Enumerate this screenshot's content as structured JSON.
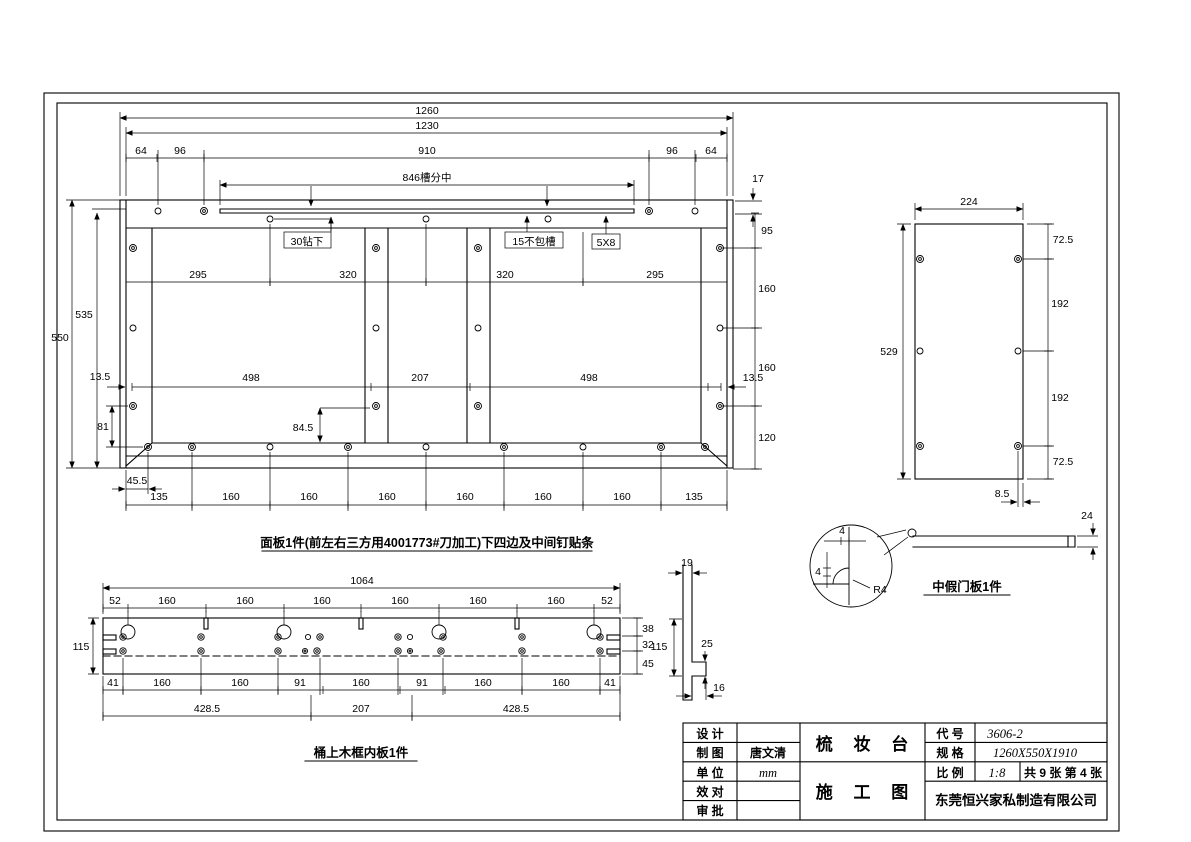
{
  "sheet": {
    "product": "梳 妆 台",
    "doc_type": "施 工 图",
    "fields": [
      {
        "label": "设 计",
        "value": ""
      },
      {
        "label": "制 图",
        "value": "唐文清"
      },
      {
        "label": "单 位",
        "value": "mm"
      },
      {
        "label": "效 对",
        "value": ""
      },
      {
        "label": "审 批",
        "value": ""
      }
    ],
    "code_label": "代 号",
    "code": "3606-2",
    "spec_label": "规 格",
    "spec": "1260X550X1910",
    "scale_label": "比 例",
    "scale": "1:8",
    "sheet_count": "共 9 张 第 4 张",
    "company": "东莞恒兴家私制造有限公司"
  },
  "panel": {
    "caption": "面板1件(前左右三方用4001773#刀加工)下四边及中间钉贴条",
    "d1260": "1260",
    "d1230": "1230",
    "chain_top": [
      "64",
      "96",
      "910",
      "96",
      "64"
    ],
    "d846": "846槽分中",
    "d17": "17",
    "note30": "30钻下",
    "note15": "15不包槽",
    "note5x8": "5X8",
    "chain_mid": [
      "295",
      "320",
      "320",
      "295"
    ],
    "d535": "535",
    "d550": "550",
    "d135l": "13.5",
    "d135r": "13.5",
    "chain_low": [
      "498",
      "207",
      "498"
    ],
    "d81": "81",
    "d845": "84.5",
    "d455": "45.5",
    "chain_right": [
      "95",
      "160",
      "160",
      "120"
    ],
    "chain_bottom": [
      "135",
      "160",
      "160",
      "160",
      "160",
      "160",
      "160",
      "135"
    ]
  },
  "door": {
    "caption": "中假门板1件",
    "d224": "224",
    "d529": "529",
    "chain_right": [
      "72.5",
      "192",
      "192",
      "72.5"
    ],
    "d85": "8.5",
    "d24": "24",
    "d4a": "4",
    "d4b": "4",
    "dr4": "R4"
  },
  "strip": {
    "caption": "桶上木框内板1件",
    "d1064": "1064",
    "chain_top": [
      "52",
      "160",
      "160",
      "160",
      "160",
      "160",
      "160",
      "52"
    ],
    "d115": "115",
    "chain_right": [
      "38",
      "32",
      "45"
    ],
    "chain_bot": [
      "41",
      "160",
      "160",
      "91",
      "160",
      "91",
      "160",
      "160",
      "41"
    ],
    "chain_bot2": [
      "428.5",
      "207",
      "428.5"
    ],
    "p19": "19",
    "p115": "115",
    "p25": "25",
    "p16": "16"
  }
}
